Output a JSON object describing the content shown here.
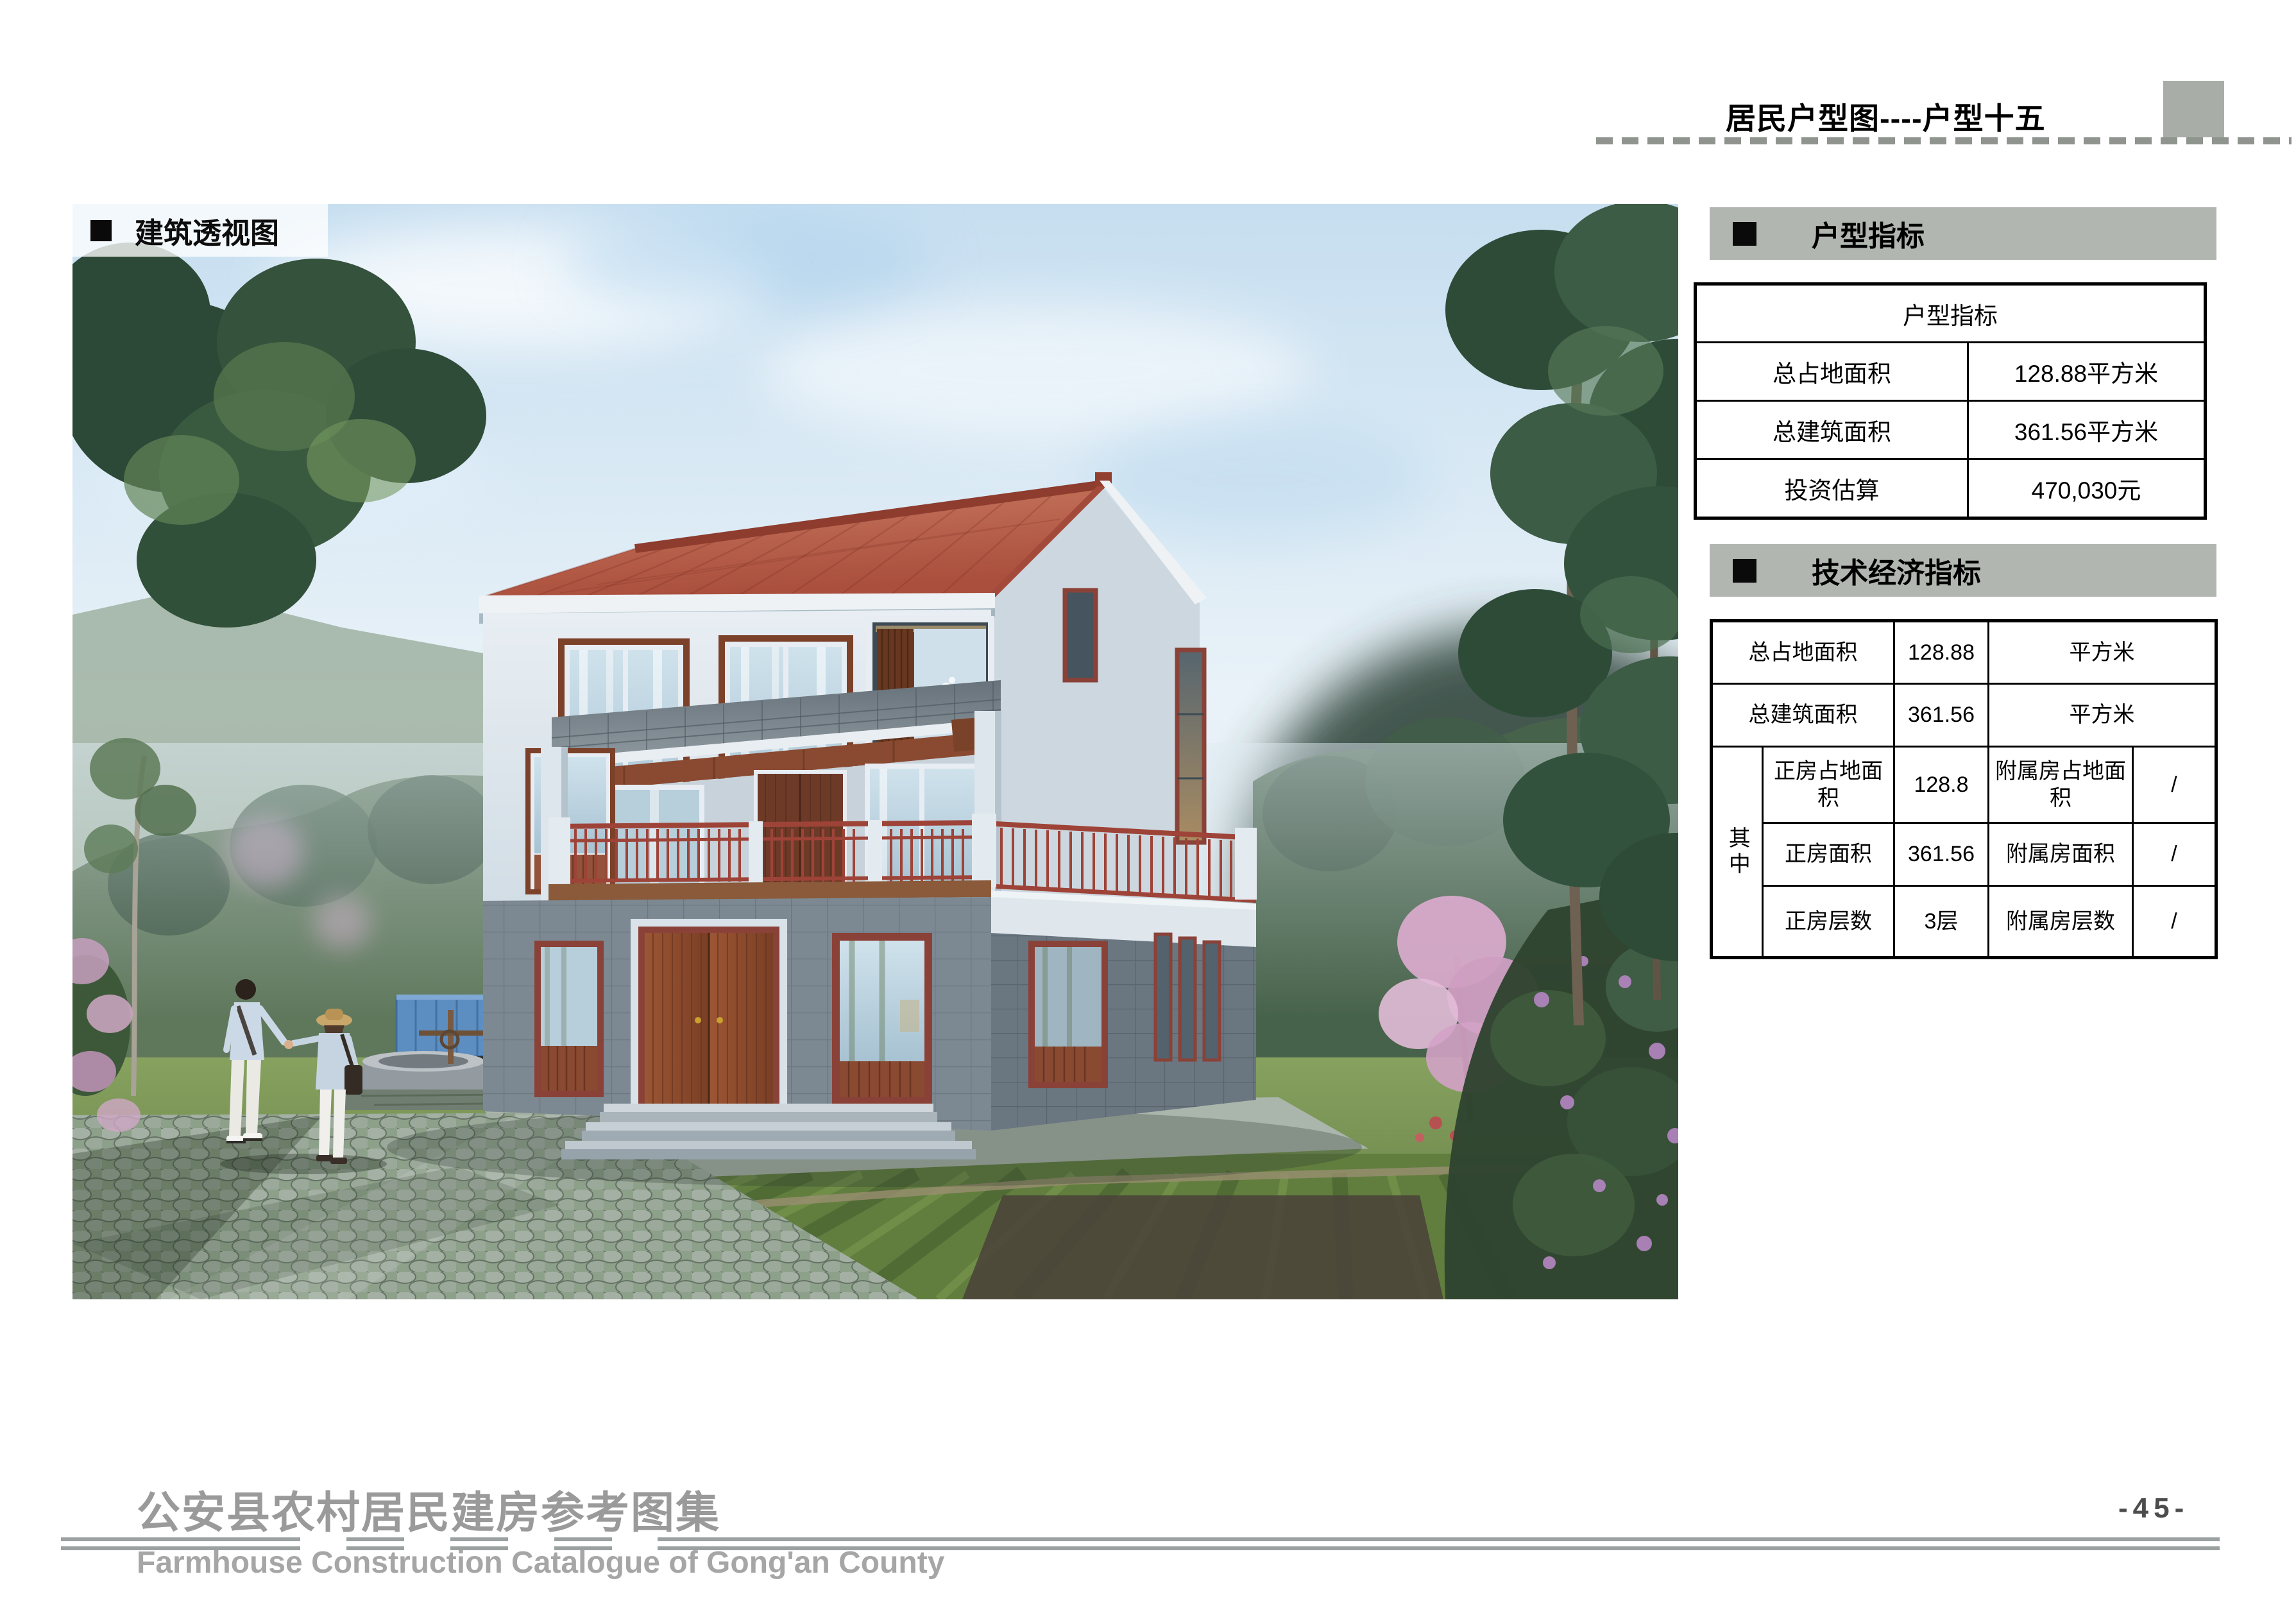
{
  "header": {
    "title": "居民户型图----户型十五"
  },
  "photo": {
    "label": "建筑透视图"
  },
  "panel": {
    "section1_title": "户型指标",
    "table1": {
      "header": "户型指标",
      "rows": [
        {
          "label": "总占地面积",
          "value": "128.88平方米"
        },
        {
          "label": "总建筑面积",
          "value": "361.56平方米"
        },
        {
          "label": "投资估算",
          "value": "470,030元"
        }
      ]
    },
    "section2_title": "技术经济指标",
    "table2": {
      "row1": {
        "label": "总占地面积",
        "value": "128.88",
        "unit": "平方米"
      },
      "row2": {
        "label": "总建筑面积",
        "value": "361.56",
        "unit": "平方米"
      },
      "group_label": "其中",
      "rows": [
        {
          "label": "正房占地面积",
          "value": "128.8",
          "label2": "附属房占地面积",
          "value2": "/"
        },
        {
          "label": "正房面积",
          "value": "361.56",
          "label2": "附属房面积",
          "value2": "/"
        },
        {
          "label": "正房层数",
          "value": "3层",
          "label2": "附属房层数",
          "value2": "/"
        }
      ]
    }
  },
  "footer": {
    "title_cn": "公安县农村居民建房参考图集",
    "title_en": "Farmhouse Construction Catalogue of Gong'an County",
    "page_number": "-45-"
  },
  "colors": {
    "band_bg": "#b2b6b0",
    "table_border": "#000000",
    "roof_red": "#b05a45",
    "wall_light": "#dce6ed",
    "wall_tile_dark": "#76838d",
    "wood_brown": "#8a4a32",
    "railing_red": "#9e4338",
    "footer_gray": "#9a9a9a"
  }
}
